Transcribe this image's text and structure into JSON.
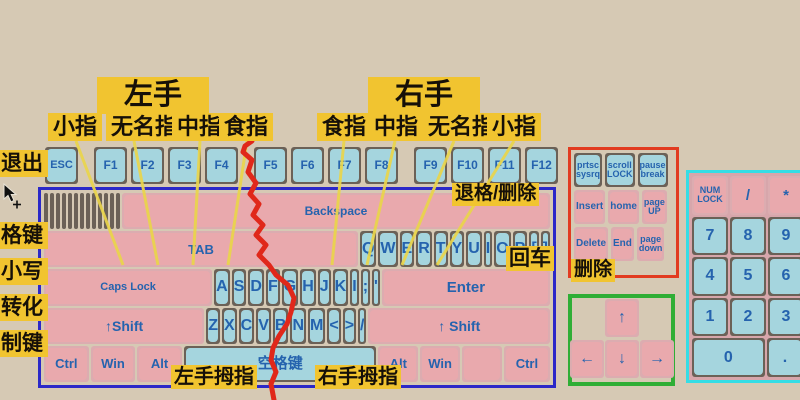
{
  "labels": {
    "left_hand": "左手",
    "right_hand": "右手",
    "fingers_left": [
      "小指",
      "无名指",
      "中指",
      "食指"
    ],
    "fingers_right": [
      "食指",
      "中指",
      "无名指",
      "小指"
    ],
    "side": [
      "退出",
      "格键",
      "小写",
      "转化",
      "制键"
    ],
    "left_thumb": "左手拇指",
    "right_thumb": "右手拇指",
    "backspace_note": "退格/删除",
    "enter_note": "回车",
    "delete_note": "删除"
  },
  "fkeys": [
    "ESC",
    "F1",
    "F2",
    "F3",
    "F4",
    "F5",
    "F6",
    "F7",
    "F8",
    "F9",
    "F10",
    "F11",
    "F12"
  ],
  "main_keyboard": {
    "rows": [
      [
        {
          "s": [
            "~",
            "`"
          ],
          "n": "backtick"
        },
        {
          "s": [
            "!",
            "1"
          ]
        },
        {
          "s": [
            "@",
            "2"
          ]
        },
        {
          "s": [
            "#",
            "3"
          ]
        },
        {
          "s": [
            "$",
            "4"
          ]
        },
        {
          "s": [
            "%",
            "5"
          ]
        },
        {
          "s": [
            "^",
            "6"
          ]
        },
        {
          "s": [
            "&",
            "7"
          ]
        },
        {
          "s": [
            "*",
            "8"
          ]
        },
        {
          "s": [
            "(",
            "9"
          ]
        },
        {
          "s": [
            ")",
            "0"
          ]
        },
        {
          "s": [
            "-",
            "_"
          ],
          "n": "minus"
        },
        {
          "s": [
            "+",
            "="
          ],
          "n": "equals"
        },
        {
          "c": "Backspace",
          "n": "backspace",
          "t": "mod",
          "f": 1.9,
          "fs": 12
        }
      ],
      [
        {
          "c": "TAB",
          "t": "mod",
          "f": 1.5,
          "fs": 13
        },
        {
          "c": "Q"
        },
        {
          "c": "W"
        },
        {
          "c": "E"
        },
        {
          "c": "R"
        },
        {
          "c": "T"
        },
        {
          "c": "Y"
        },
        {
          "c": "U"
        },
        {
          "c": "I"
        },
        {
          "c": "O"
        },
        {
          "c": "P"
        },
        {
          "c": "[",
          "n": "bracket-open"
        },
        {
          "c": "]",
          "n": "bracket-close"
        }
      ],
      [
        {
          "c": "Caps Lock",
          "t": "mod",
          "f": 1.8,
          "fs": 11
        },
        {
          "c": "A"
        },
        {
          "c": "S"
        },
        {
          "c": "D"
        },
        {
          "c": "F"
        },
        {
          "c": "G"
        },
        {
          "c": "H"
        },
        {
          "c": "J"
        },
        {
          "c": "K"
        },
        {
          "c": "I",
          "n": "l-position"
        },
        {
          "c": ";",
          "n": "semicolon"
        },
        {
          "c": "'",
          "n": "apostrophe"
        },
        {
          "c": "Enter",
          "t": "mod",
          "f": 1.8,
          "fs": 15
        }
      ],
      [
        {
          "c": "↑Shift",
          "n": "shift-left",
          "t": "mod",
          "f": 2.2,
          "fs": 14
        },
        {
          "c": "Z"
        },
        {
          "c": "X"
        },
        {
          "c": "C"
        },
        {
          "c": "V"
        },
        {
          "c": "B"
        },
        {
          "c": "N"
        },
        {
          "c": "M"
        },
        {
          "c": "<",
          "n": "less-than"
        },
        {
          "c": ">",
          "n": "greater-than"
        },
        {
          "c": "/",
          "n": "slash"
        },
        {
          "c": "↑ Shift",
          "n": "shift-right",
          "t": "mod",
          "f": 2.5,
          "fs": 14
        }
      ],
      [
        {
          "c": "Ctrl",
          "n": "ctrl-left",
          "t": "mod",
          "f": 1.25,
          "fs": 13
        },
        {
          "c": "Win",
          "n": "win-left",
          "t": "mod",
          "f": 1.25,
          "fs": 13
        },
        {
          "c": "Alt",
          "n": "alt-left",
          "t": "mod",
          "f": 1.25,
          "fs": 13
        },
        {
          "c": "空格键",
          "n": "space",
          "f": 5.8,
          "fs": 15
        },
        {
          "c": "Alt",
          "n": "alt-right",
          "t": "mod",
          "f": 1.1,
          "fs": 13
        },
        {
          "c": "Win",
          "n": "win-right",
          "t": "mod",
          "f": 1.1,
          "fs": 13
        },
        {
          "c": "",
          "n": "blank",
          "t": "mod",
          "f": 1.1
        },
        {
          "c": "Ctrl",
          "n": "ctrl-right",
          "t": "mod",
          "f": 1.3,
          "fs": 13
        }
      ]
    ]
  },
  "nav_cluster": {
    "rows": [
      [
        {
          "c": "prtsc\nsysrq",
          "fs": 9
        },
        {
          "c": "scroll\nLOCK",
          "fs": 9
        },
        {
          "c": "pause\nbreak",
          "fs": 9
        }
      ],
      [
        {
          "c": "Insert",
          "t": "mod",
          "fs": 10
        },
        {
          "c": "home",
          "t": "mod",
          "fs": 10
        },
        {
          "c": "page\nUP",
          "t": "mod",
          "fs": 9
        }
      ],
      [
        {
          "c": "Delete",
          "t": "mod",
          "fs": 10
        },
        {
          "c": "End",
          "t": "mod",
          "fs": 10
        },
        {
          "c": "page\ndown",
          "t": "mod",
          "fs": 9
        }
      ]
    ]
  },
  "arrow_cluster": {
    "up": "↑",
    "left": "←",
    "down": "↓",
    "right": "→"
  },
  "numpad": {
    "rows": [
      [
        {
          "c": "NUM\nLOCK",
          "t": "mod",
          "fs": 9
        },
        {
          "c": "/",
          "n": "divide",
          "t": "mod",
          "fs": 15
        },
        {
          "c": "*",
          "n": "multiply",
          "t": "mod",
          "fs": 15
        },
        {
          "c": "",
          "n": "clipped",
          "t": "mod"
        }
      ],
      [
        {
          "c": "7"
        },
        {
          "c": "8"
        },
        {
          "c": "9"
        },
        {
          "c": "",
          "n": "clipped"
        }
      ],
      [
        {
          "c": "4"
        },
        {
          "c": "5"
        },
        {
          "c": "6"
        },
        {
          "c": "",
          "n": "clipped"
        }
      ],
      [
        {
          "c": "1"
        },
        {
          "c": "2"
        },
        {
          "c": "3"
        },
        {
          "c": "",
          "n": "clipped"
        }
      ],
      [
        {
          "c": "0",
          "wide": true
        },
        {
          "c": ".",
          "n": "decimal"
        },
        {
          "c": "",
          "n": "clipped",
          "t": "mod"
        }
      ]
    ]
  },
  "colors": {
    "background": "#d6c9b4",
    "key_cap_blue": "#a5d5de",
    "key_cap_pink": "#e9a9ad",
    "key_surround": "#6b6157",
    "key_text_blue": "#2563ae",
    "label_yellow": "#f1c430",
    "border_main_keyboard": "#2b28c8",
    "border_nav_cluster": "#e23b20",
    "border_arrow_cluster": "#2fae35",
    "border_numpad": "#35dde5",
    "divider_red": "#e0281a",
    "connector_yellow": "#ead54b"
  }
}
